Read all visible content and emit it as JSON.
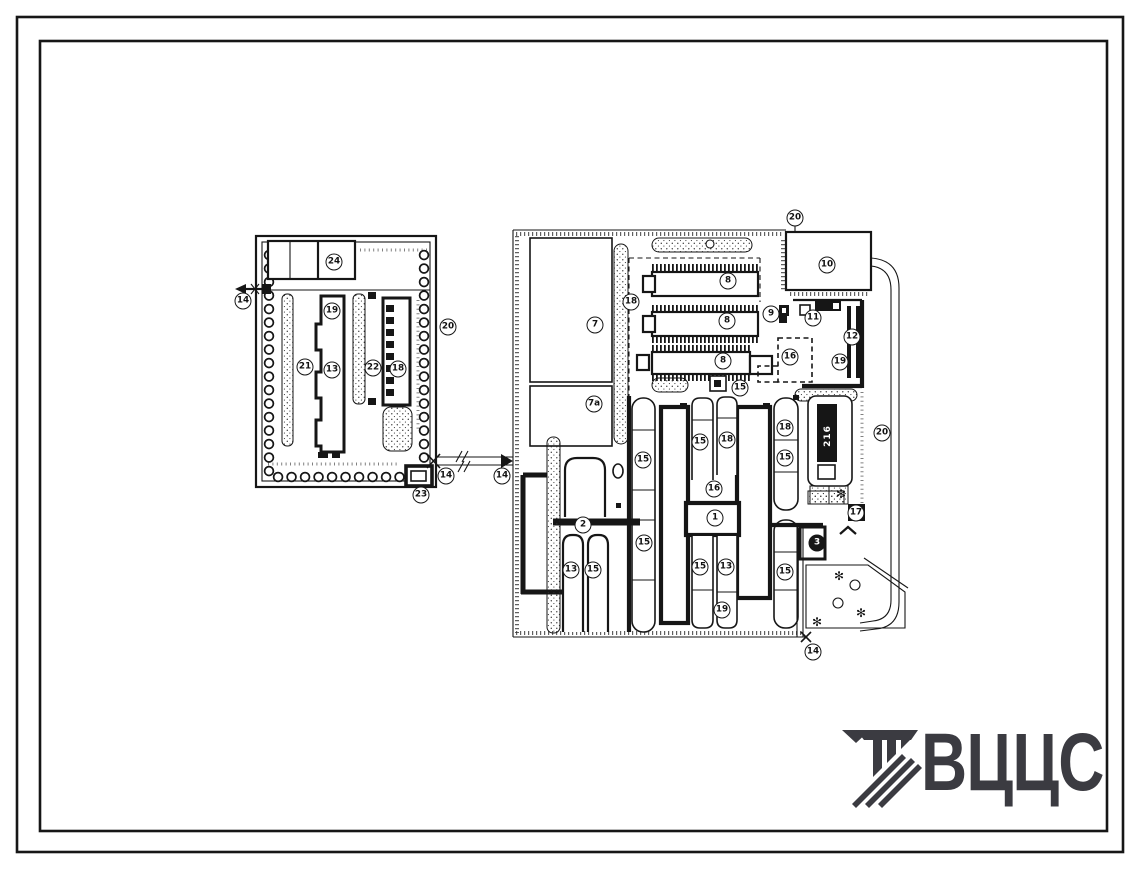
{
  "sheet": {
    "background": "#ffffff",
    "ink": "#161616"
  },
  "logo": {
    "text": "ВЦЦС",
    "color": "#3b3b41",
    "icon": "hatched-bars-mark"
  },
  "plan": {
    "tower_text": "216",
    "labels": [
      {
        "v": "14",
        "x": 243,
        "y": 301
      },
      {
        "v": "24",
        "x": 334,
        "y": 262
      },
      {
        "v": "19",
        "x": 332,
        "y": 311
      },
      {
        "v": "21",
        "x": 305,
        "y": 367
      },
      {
        "v": "13",
        "x": 332,
        "y": 370
      },
      {
        "v": "22",
        "x": 373,
        "y": 368
      },
      {
        "v": "18",
        "x": 398,
        "y": 369
      },
      {
        "v": "20",
        "x": 448,
        "y": 327
      },
      {
        "v": "23",
        "x": 421,
        "y": 495
      },
      {
        "v": "14",
        "x": 446,
        "y": 476
      },
      {
        "v": "14",
        "x": 502,
        "y": 476
      },
      {
        "v": "20",
        "x": 795,
        "y": 218
      },
      {
        "v": "10",
        "x": 827,
        "y": 265
      },
      {
        "v": "7",
        "x": 595,
        "y": 325
      },
      {
        "v": "7а",
        "x": 594,
        "y": 404
      },
      {
        "v": "18",
        "x": 631,
        "y": 302
      },
      {
        "v": "8",
        "x": 728,
        "y": 281
      },
      {
        "v": "8",
        "x": 727,
        "y": 321
      },
      {
        "v": "8",
        "x": 723,
        "y": 361
      },
      {
        "v": "9",
        "x": 771,
        "y": 314
      },
      {
        "v": "11",
        "x": 813,
        "y": 318
      },
      {
        "v": "12",
        "x": 852,
        "y": 337
      },
      {
        "v": "19",
        "x": 840,
        "y": 362
      },
      {
        "v": "16",
        "x": 790,
        "y": 357
      },
      {
        "v": "15",
        "x": 740,
        "y": 388
      },
      {
        "v": "2",
        "x": 583,
        "y": 525
      },
      {
        "v": "13",
        "x": 571,
        "y": 570
      },
      {
        "v": "15",
        "x": 593,
        "y": 570
      },
      {
        "v": "15",
        "x": 643,
        "y": 460
      },
      {
        "v": "15",
        "x": 644,
        "y": 543
      },
      {
        "v": "15",
        "x": 700,
        "y": 442
      },
      {
        "v": "18",
        "x": 727,
        "y": 440
      },
      {
        "v": "16",
        "x": 714,
        "y": 489
      },
      {
        "v": "1",
        "x": 715,
        "y": 518
      },
      {
        "v": "15",
        "x": 700,
        "y": 567
      },
      {
        "v": "13",
        "x": 726,
        "y": 567
      },
      {
        "v": "19",
        "x": 722,
        "y": 610
      },
      {
        "v": "18",
        "x": 785,
        "y": 428
      },
      {
        "v": "15",
        "x": 785,
        "y": 458
      },
      {
        "v": "15",
        "x": 785,
        "y": 572
      },
      {
        "v": "3",
        "x": 817,
        "y": 543,
        "dark": true
      },
      {
        "v": "17",
        "x": 856,
        "y": 513
      },
      {
        "v": "20",
        "x": 882,
        "y": 433
      },
      {
        "v": "14",
        "x": 813,
        "y": 652
      }
    ]
  }
}
